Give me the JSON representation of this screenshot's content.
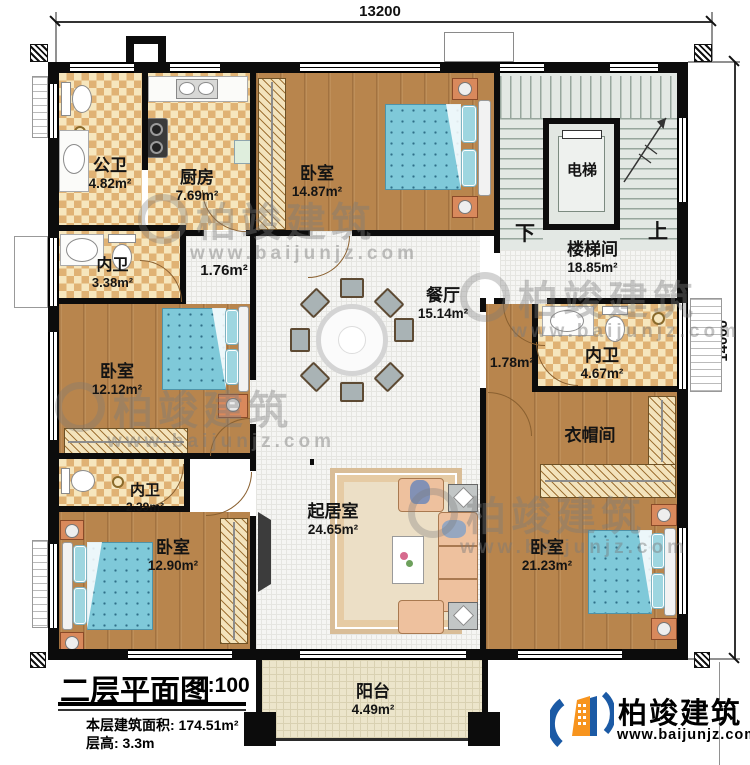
{
  "dims": {
    "width": "13200",
    "height": "14000"
  },
  "rooms": {
    "public_bath": {
      "name": "公卫",
      "area": "4.82m²"
    },
    "kitchen": {
      "name": "厨房",
      "area": "7.69m²"
    },
    "bedroom_top": {
      "name": "卧室",
      "area": "14.87m²"
    },
    "elevator": {
      "name": "电梯"
    },
    "stairwell": {
      "name": "楼梯间",
      "area": "18.85m²",
      "down": "下",
      "up": "上"
    },
    "bath_left": {
      "name": "内卫",
      "area": "3.38m²"
    },
    "hall_left": {
      "area": "1.76m²"
    },
    "dining": {
      "name": "餐厅",
      "area": "15.14m²"
    },
    "hall_right": {
      "area": "1.78m²"
    },
    "bath_right": {
      "name": "内卫",
      "area": "4.67m²"
    },
    "bedroom_left": {
      "name": "卧室",
      "area": "12.12m²"
    },
    "cloakroom": {
      "name": "衣帽间"
    },
    "bath_small": {
      "name": "内卫",
      "area": "2.39m²"
    },
    "bedroom_bottom_left": {
      "name": "卧室",
      "area": "12.90m²"
    },
    "living": {
      "name": "起居室",
      "area": "24.65m²"
    },
    "bedroom_bottom_right": {
      "name": "卧室",
      "area": "21.23m²"
    },
    "balcony": {
      "name": "阳台",
      "area": "4.49m²"
    }
  },
  "title_block": {
    "title": "二层平面图",
    "scale": "1:100",
    "floor_area": "本层建筑面积: 174.51m²",
    "floor_height": "层高: 3.3m"
  },
  "brand": {
    "name": "柏竣建筑",
    "site": "www.baijunjz.com"
  },
  "watermark": {
    "name": "柏竣建筑",
    "site": "www.baijunjz.com"
  },
  "colors": {
    "wall": "#0c0c0c",
    "wood": "#b8854d",
    "checker_tan": "#e0b274",
    "bed_blue": "#7fc9d9",
    "logo_blue": "#1b5aa5",
    "logo_orange": "#f7941e"
  }
}
